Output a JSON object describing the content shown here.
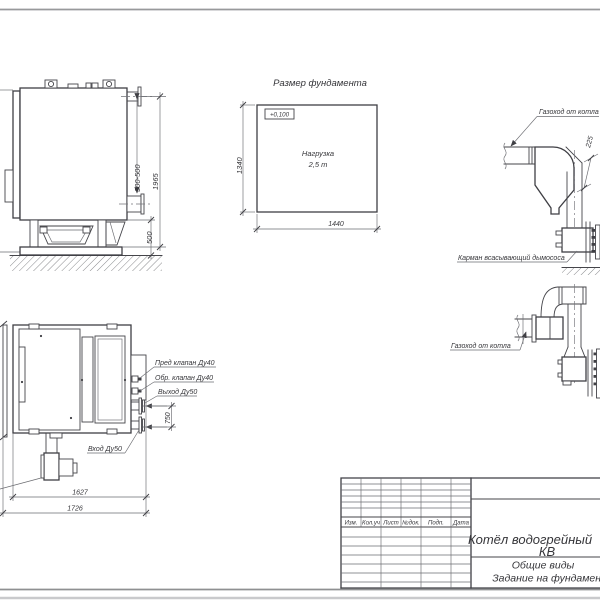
{
  "side_view": {
    "dim_total_height": "1965",
    "dim_outlet_range": "300-500",
    "dim_foundation_height": "500"
  },
  "foundation": {
    "title": "Размер фундамента",
    "elevation_mark": "+0,100",
    "load_line1": "Нагрузка",
    "load_line2": "2,5 т",
    "dim_depth": "1340",
    "dim_width": "1440"
  },
  "duct_plan": {
    "label_flue": "Газоход от котла",
    "dim_offset": "225",
    "label_pocket": "Карман всасывающий дымососа"
  },
  "duct_side": {
    "label_flue": "Газоход от котла"
  },
  "plan_view": {
    "label_safety_valve": "Пред клапан Ду40",
    "label_check_valve": "Обр. клапан Ду40",
    "label_outlet": "Выход Ду50",
    "label_inlet": "Вход Ду50",
    "dim_pipe_spacing": "750",
    "dim_inner_length": "1627",
    "dim_total_length": "1726"
  },
  "title_block": {
    "col_izm": "Изм.",
    "col_koluch": "Кол.уч",
    "col_list": "Лист",
    "col_ndoc": "№док.",
    "col_podp": "Подп.",
    "col_data": "Дата",
    "product_line1": "Котёл водогрейный",
    "product_line2": "КВ",
    "doc_line1": "Общие виды",
    "doc_line2": "Задание на фундамент"
  }
}
